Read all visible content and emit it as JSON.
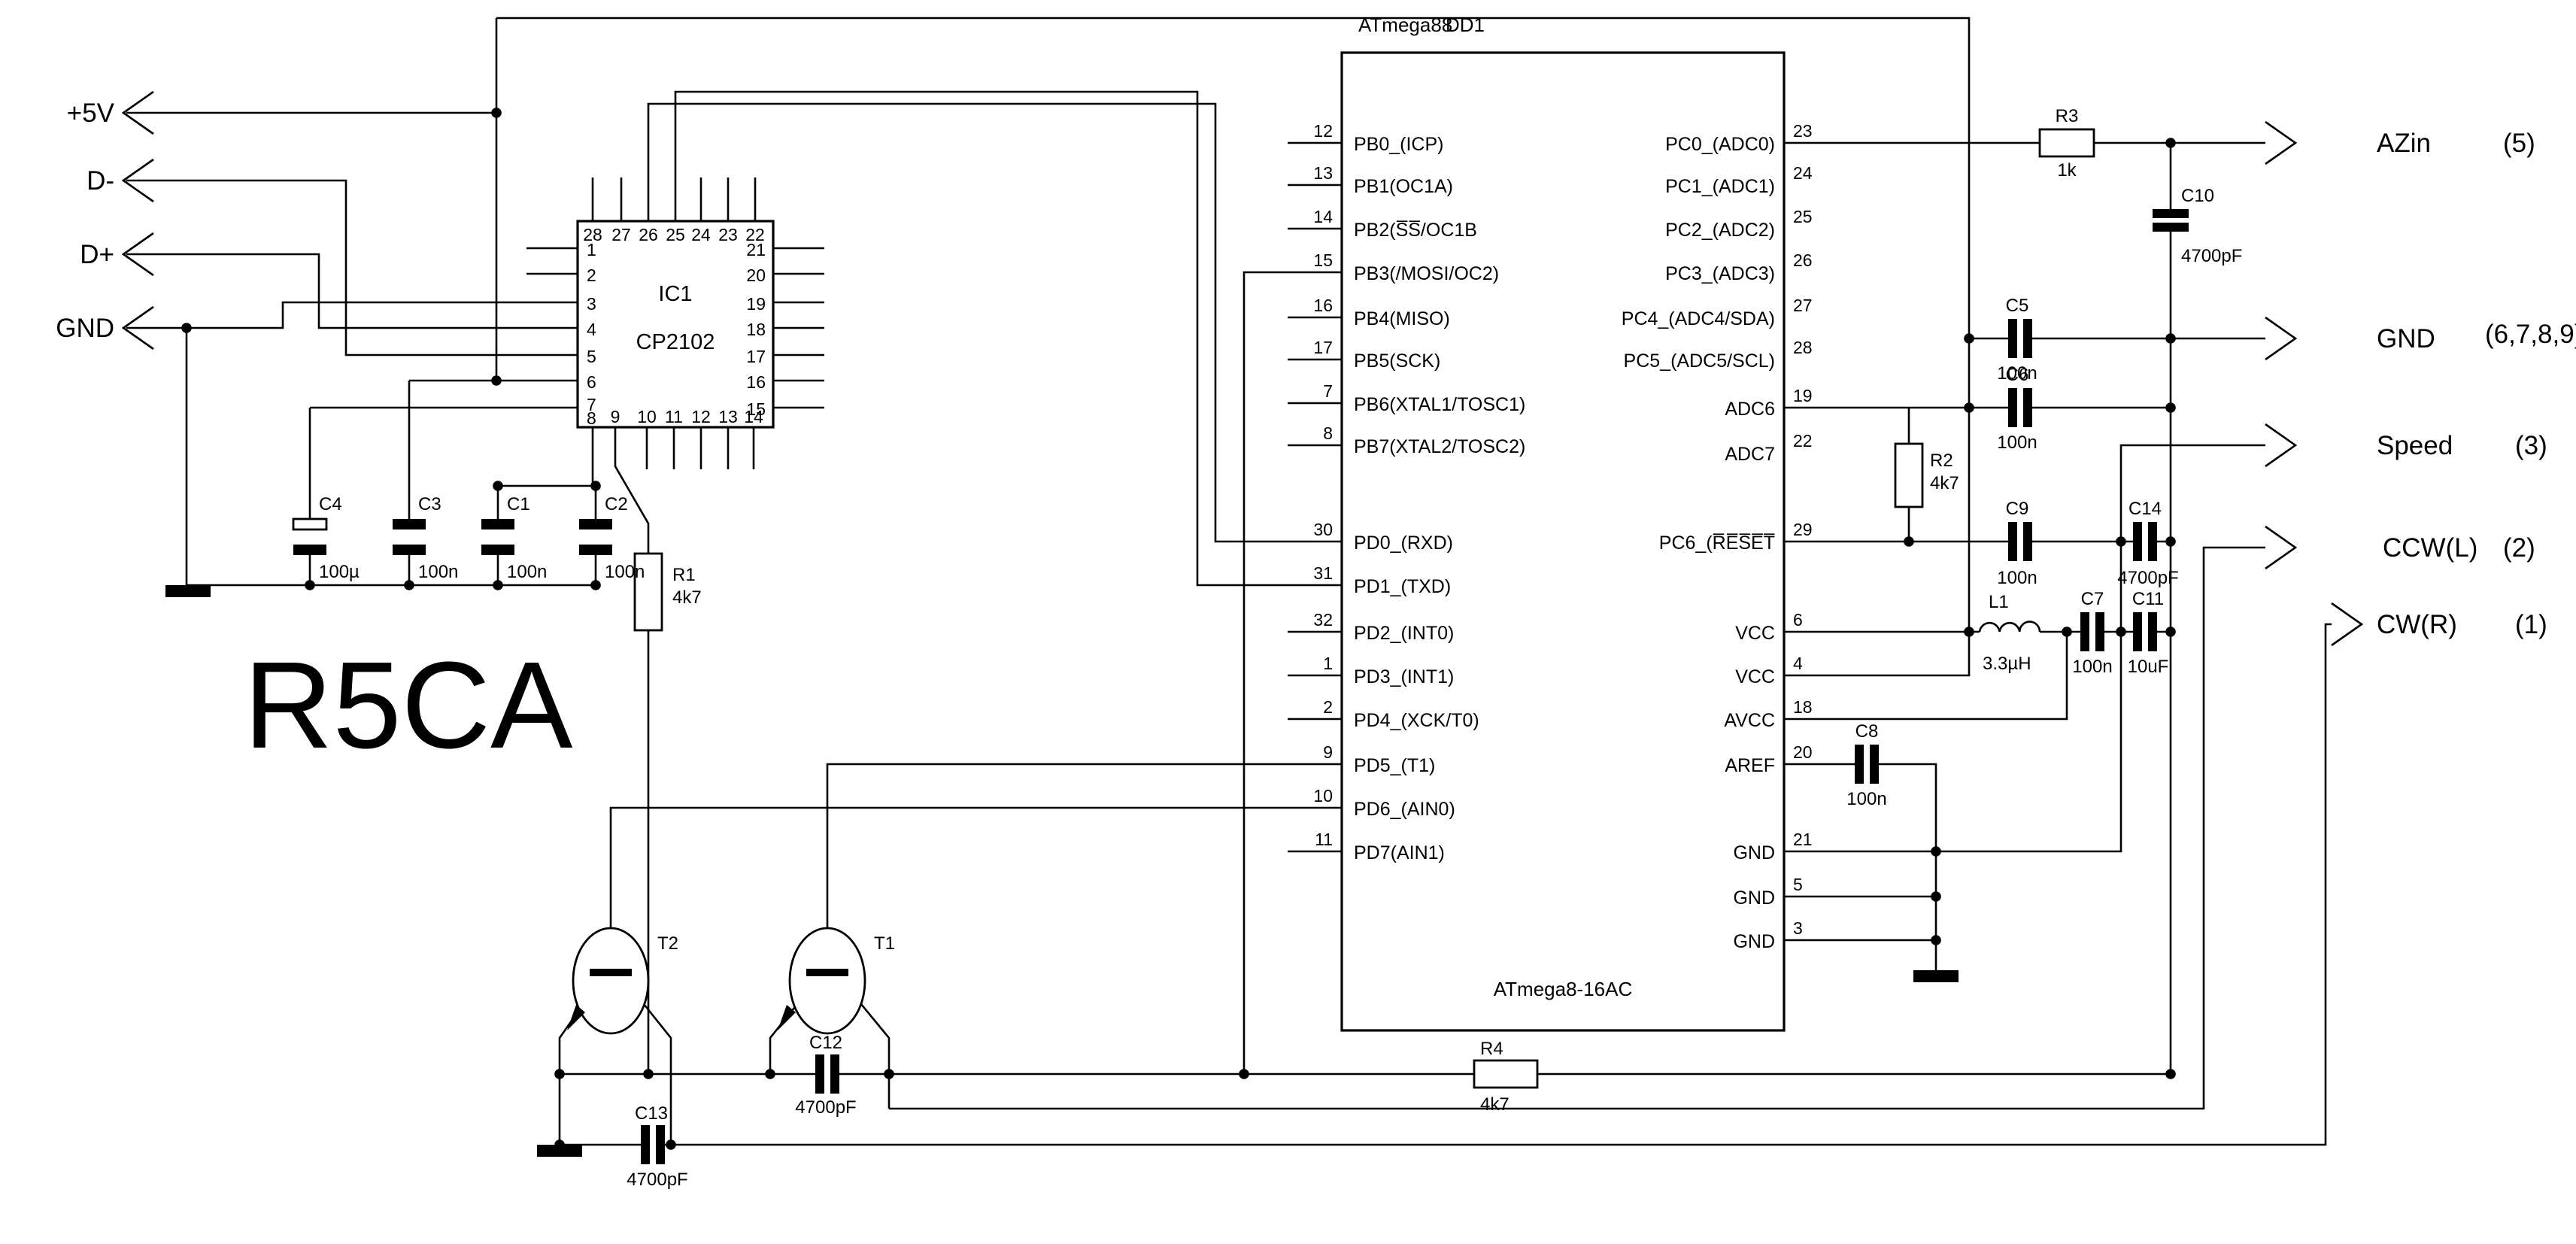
{
  "title": "R5CA",
  "colors": {
    "line": "#000000",
    "background": "#ffffff"
  },
  "mcu": {
    "name_top": "ATmega88",
    "ref": "DD1",
    "name_bottom": "ATmega8-16AC",
    "left_pins": [
      {
        "n": "12",
        "l": "PB0_(ICP)"
      },
      {
        "n": "13",
        "l": "PB1(OC1A)"
      },
      {
        "n": "14",
        "l": "PB2(S̅S̅/OC1B"
      },
      {
        "n": "15",
        "l": "PB3(/MOSI/OC2)"
      },
      {
        "n": "16",
        "l": "PB4(MISO)"
      },
      {
        "n": "17",
        "l": "PB5(SCK)"
      },
      {
        "n": "7",
        "l": "PB6(XTAL1/TOSC1)"
      },
      {
        "n": "8",
        "l": "PB7(XTAL2/TOSC2)"
      },
      {
        "n": "30",
        "l": "PD0_(RXD)"
      },
      {
        "n": "31",
        "l": "PD1_(TXD)"
      },
      {
        "n": "32",
        "l": "PD2_(INT0)"
      },
      {
        "n": "1",
        "l": "PD3_(INT1)"
      },
      {
        "n": "2",
        "l": "PD4_(XCK/T0)"
      },
      {
        "n": "9",
        "l": "PD5_(T1)"
      },
      {
        "n": "10",
        "l": "PD6_(AIN0)"
      },
      {
        "n": "11",
        "l": "PD7(AIN1)"
      }
    ],
    "right_pins": [
      {
        "n": "23",
        "l": "PC0_(ADC0)"
      },
      {
        "n": "24",
        "l": "PC1_(ADC1)"
      },
      {
        "n": "25",
        "l": "PC2_(ADC2)"
      },
      {
        "n": "26",
        "l": "PC3_(ADC3)"
      },
      {
        "n": "27",
        "l": "PC4_(ADC4/SDA)"
      },
      {
        "n": "28",
        "l": "PC5_(ADC5/SCL)"
      },
      {
        "n": "19",
        "l": "ADC6"
      },
      {
        "n": "22",
        "l": "ADC7"
      },
      {
        "n": "29",
        "l": "PC6_(R̅E̅S̅E̅T̅"
      },
      {
        "n": "6",
        "l": "VCC"
      },
      {
        "n": "4",
        "l": "VCC"
      },
      {
        "n": "18",
        "l": "AVCC"
      },
      {
        "n": "20",
        "l": "AREF"
      },
      {
        "n": "21",
        "l": "GND"
      },
      {
        "n": "5",
        "l": "GND"
      },
      {
        "n": "3",
        "l": "GND"
      }
    ]
  },
  "ic1": {
    "ref": "IC1",
    "part": "CP2102",
    "top_pins": [
      "28",
      "27",
      "26",
      "25",
      "24",
      "23",
      "22"
    ],
    "left_pins": [
      "1",
      "2",
      "3",
      "4",
      "5",
      "6",
      "7"
    ],
    "bottom_left": "8",
    "bottom_pins": [
      "9",
      "10",
      "11",
      "12",
      "13",
      "14"
    ],
    "right_pins": [
      "21",
      "20",
      "19",
      "18",
      "17",
      "16",
      "15"
    ]
  },
  "inputs": [
    {
      "label": "+5V"
    },
    {
      "label": "D-"
    },
    {
      "label": "D+"
    },
    {
      "label": "GND"
    }
  ],
  "outputs": [
    {
      "label": "AZin",
      "pins": "(5)"
    },
    {
      "label": "GND",
      "pins": "(6,7,8,9)"
    },
    {
      "label": "Speed",
      "pins": "(3)"
    },
    {
      "label": "CCW(L)",
      "pins": "(2)"
    },
    {
      "label": "CW(R)",
      "pins": "(1)"
    }
  ],
  "components": {
    "R1": {
      "ref": "R1",
      "value": "4k7"
    },
    "R2": {
      "ref": "R2",
      "value": "4k7"
    },
    "R3": {
      "ref": "R3",
      "value": "1k"
    },
    "R4": {
      "ref": "R4",
      "value": "4k7"
    },
    "C1": {
      "ref": "C1",
      "value": "100n"
    },
    "C2": {
      "ref": "C2",
      "value": "100n"
    },
    "C3": {
      "ref": "C3",
      "value": "100n"
    },
    "C4": {
      "ref": "C4",
      "value": "100µ"
    },
    "C5": {
      "ref": "C5",
      "value": "100n"
    },
    "C6": {
      "ref": "C6",
      "value": "100n"
    },
    "C7": {
      "ref": "C7",
      "value": "100n"
    },
    "C8": {
      "ref": "C8",
      "value": "100n"
    },
    "C9": {
      "ref": "C9",
      "value": "100n"
    },
    "C10": {
      "ref": "C10",
      "value": "4700pF"
    },
    "C11": {
      "ref": "C11",
      "value": "10uF"
    },
    "C12": {
      "ref": "C12",
      "value": "4700pF"
    },
    "C13": {
      "ref": "C13",
      "value": "4700pF"
    },
    "C14": {
      "ref": "C14",
      "value": "4700pF"
    },
    "L1": {
      "ref": "L1",
      "value": "3.3µH"
    },
    "T1": {
      "ref": "T1"
    },
    "T2": {
      "ref": "T2"
    }
  }
}
